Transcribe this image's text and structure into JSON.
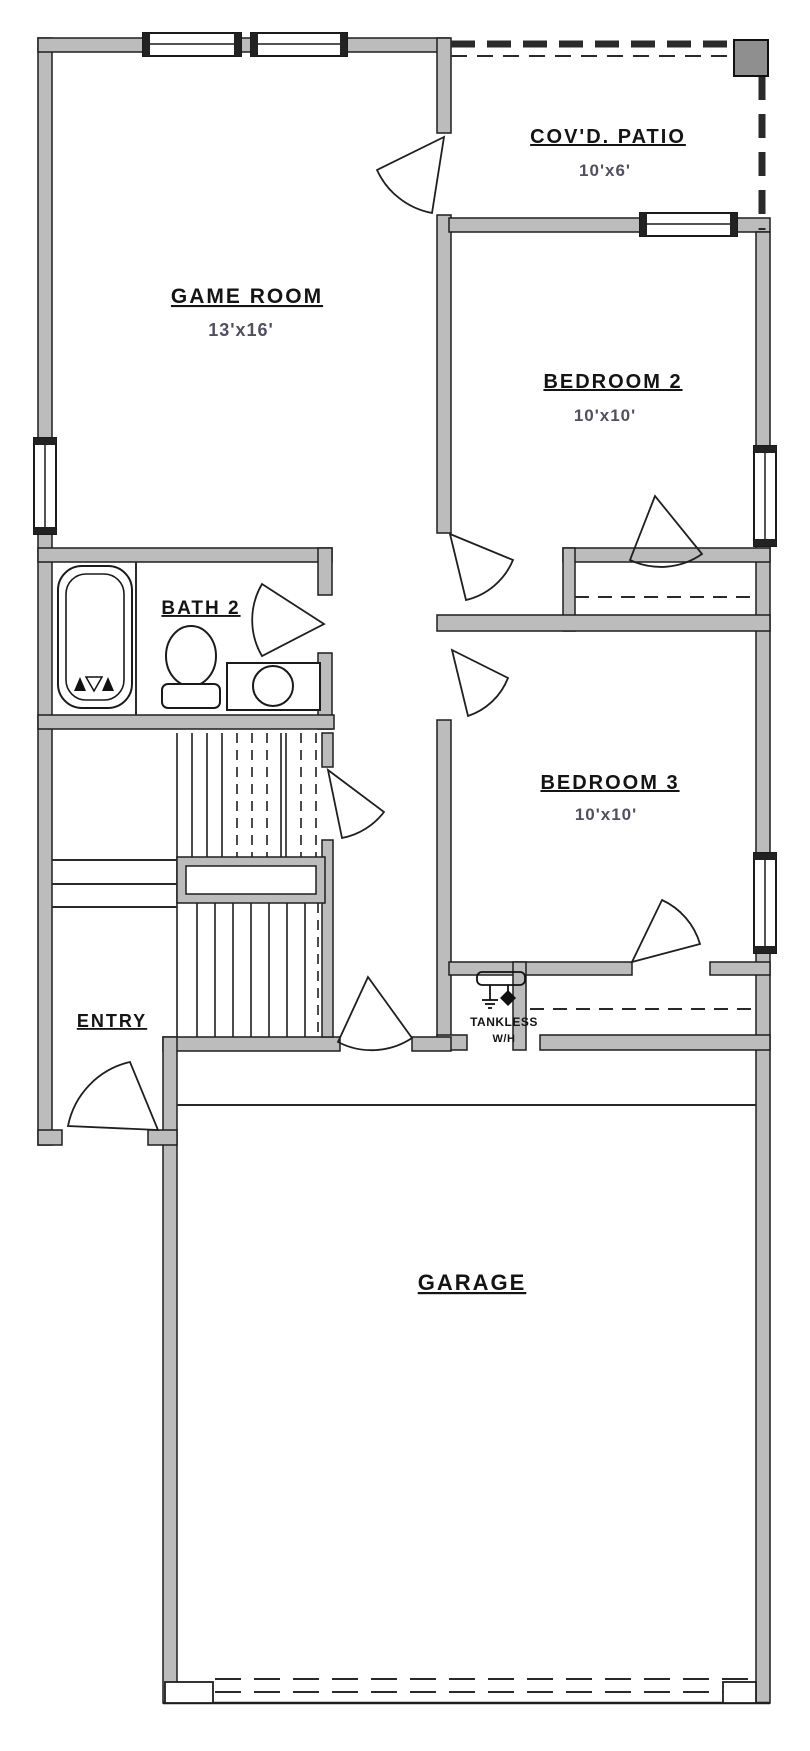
{
  "plan": {
    "type": "residential-floor-plan",
    "colors": {
      "background": "#ffffff",
      "wall_fill": "#bcbcbc",
      "wall_stroke": "#1f1f1f",
      "label_text": "#141414",
      "dimension_text": "#50505e"
    },
    "rooms": {
      "game_room": {
        "name": "GAME ROOM",
        "dims": "13'x16'"
      },
      "covd_patio": {
        "name": "COV'D. PATIO",
        "dims": "10'x6'"
      },
      "bedroom_2": {
        "name": "BEDROOM 2",
        "dims": "10'x10'"
      },
      "bath_2": {
        "name": "BATH 2"
      },
      "bedroom_3": {
        "name": "BEDROOM 3",
        "dims": "10'x10'"
      },
      "entry": {
        "name": "ENTRY"
      },
      "tankless": {
        "name": "TANKLESS",
        "name2": "W/H"
      },
      "garage": {
        "name": "GARAGE"
      }
    }
  }
}
